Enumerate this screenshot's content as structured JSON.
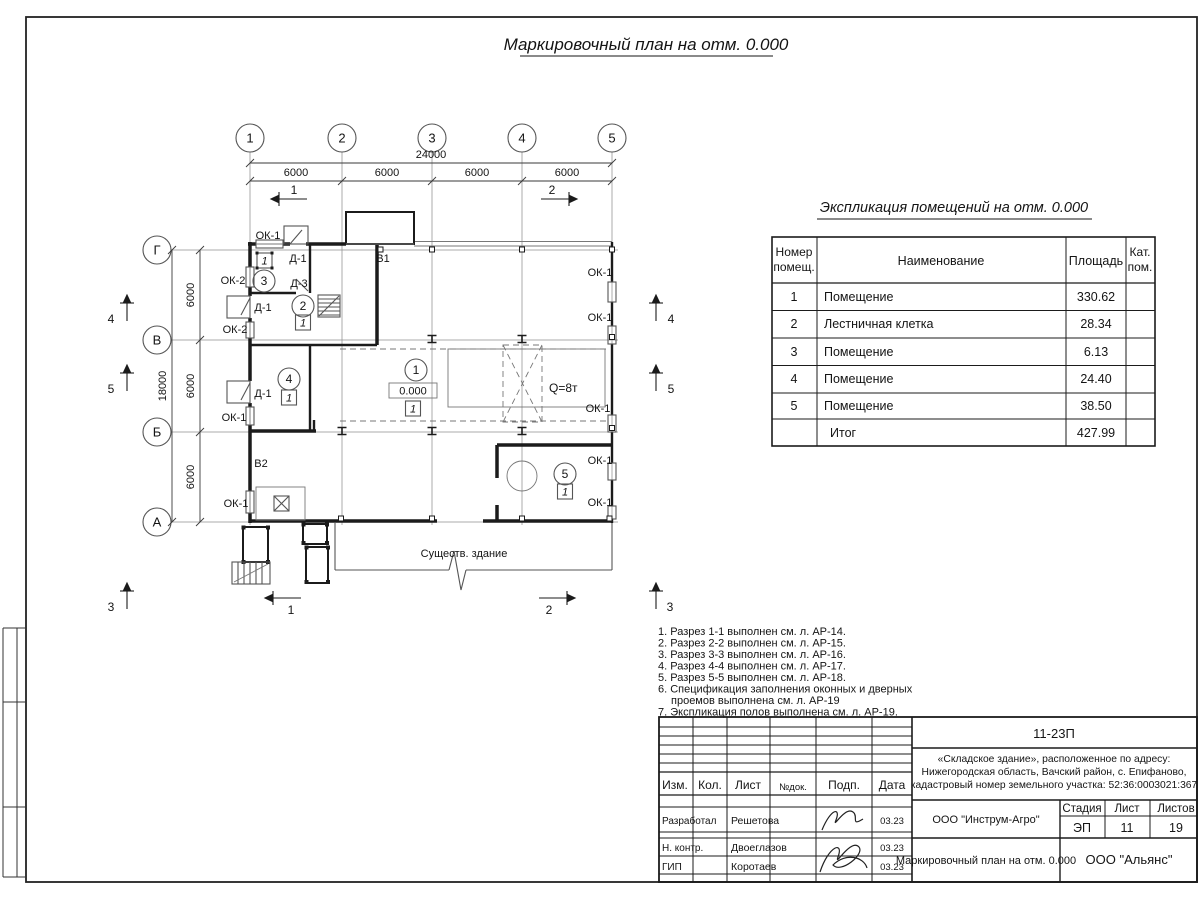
{
  "sheet": {
    "title": "Маркировочный план на отм. 0.000"
  },
  "plan": {
    "grid": {
      "cols": [
        "1",
        "2",
        "3",
        "4",
        "5"
      ],
      "rows": [
        "Г",
        "В",
        "Б",
        "А"
      ]
    },
    "dims": {
      "total_w": "24000",
      "bay": "6000",
      "total_h": "18000"
    },
    "labels": {
      "ok1": "ОК-1",
      "ok2": "ОК-2",
      "d1": "Д-1",
      "d3": "Д-3",
      "v1": "В1",
      "v2": "В2",
      "crane": "Q=8т",
      "elevation": "0.000",
      "existing": "Существ. здание",
      "floor_tag": "1"
    },
    "rooms": [
      "1",
      "2",
      "3",
      "4",
      "5"
    ],
    "sections": [
      "1",
      "2",
      "3",
      "4",
      "5"
    ]
  },
  "schedule": {
    "title": "Экспликация помещений на отм. 0.000",
    "headers": {
      "num1": "Номер",
      "num2": "помещ.",
      "name": "Наименование",
      "area": "Площадь",
      "cat1": "Кат.",
      "cat2": "пом."
    },
    "rows": [
      {
        "num": "1",
        "name": "Помещение",
        "area": "330.62"
      },
      {
        "num": "2",
        "name": "Лестничная клетка",
        "area": "28.34"
      },
      {
        "num": "3",
        "name": "Помещение",
        "area": "6.13"
      },
      {
        "num": "4",
        "name": "Помещение",
        "area": "24.40"
      },
      {
        "num": "5",
        "name": "Помещение",
        "area": "38.50"
      }
    ],
    "total": {
      "name": "Итог",
      "area": "427.99"
    }
  },
  "notes": {
    "l1": "1. Разрез 1-1 выполнен см. л. АР-14.",
    "l2": "2. Разрез 2-2 выполнен см. л. АР-15.",
    "l3": "3. Разрез 3-3 выполнен см. л. АР-16.",
    "l4": "4. Разрез 4-4 выполнен см. л. АР-17.",
    "l5": "5. Разрез 5-5 выполнен см. л. АР-18.",
    "l6a": "6. Спецификация заполнения оконных и дверных",
    "l6b": "проемов выполнена см. л. АР-19",
    "l7": "7. Экспликация полов выполнена см. л. АР-19."
  },
  "titleblock": {
    "doc_number": "11-23П",
    "address1": "«Складское здание», расположенное по адресу:",
    "address2": "Нижегородская область, Вачский район, с. Епифаново,",
    "address3": "кадастровый номер земельного участка: 52:36:0003021:367",
    "cols": {
      "izm": "Изм.",
      "kol": "Кол.",
      "list": "Лист",
      "ndok": "№док.",
      "podp": "Подп.",
      "data": "Дата"
    },
    "stage_label": "Стадия",
    "sheet_label": "Лист",
    "sheets_label": "Листов",
    "stage": "ЭП",
    "sheet_no": "11",
    "sheets_total": "19",
    "org": "ООО \"Инструм-Агро\"",
    "drawing_title": "Маркировочный план на отм. 0.000",
    "company": "ООО \"Альянс\"",
    "roles": {
      "developed": "Разработал",
      "ncontr": "Н. контр.",
      "gip": "ГИП"
    },
    "names": {
      "developed": "Решетова",
      "ncontr": "Двоеглазов",
      "gip": "Коротаев"
    },
    "date": "03.23"
  }
}
